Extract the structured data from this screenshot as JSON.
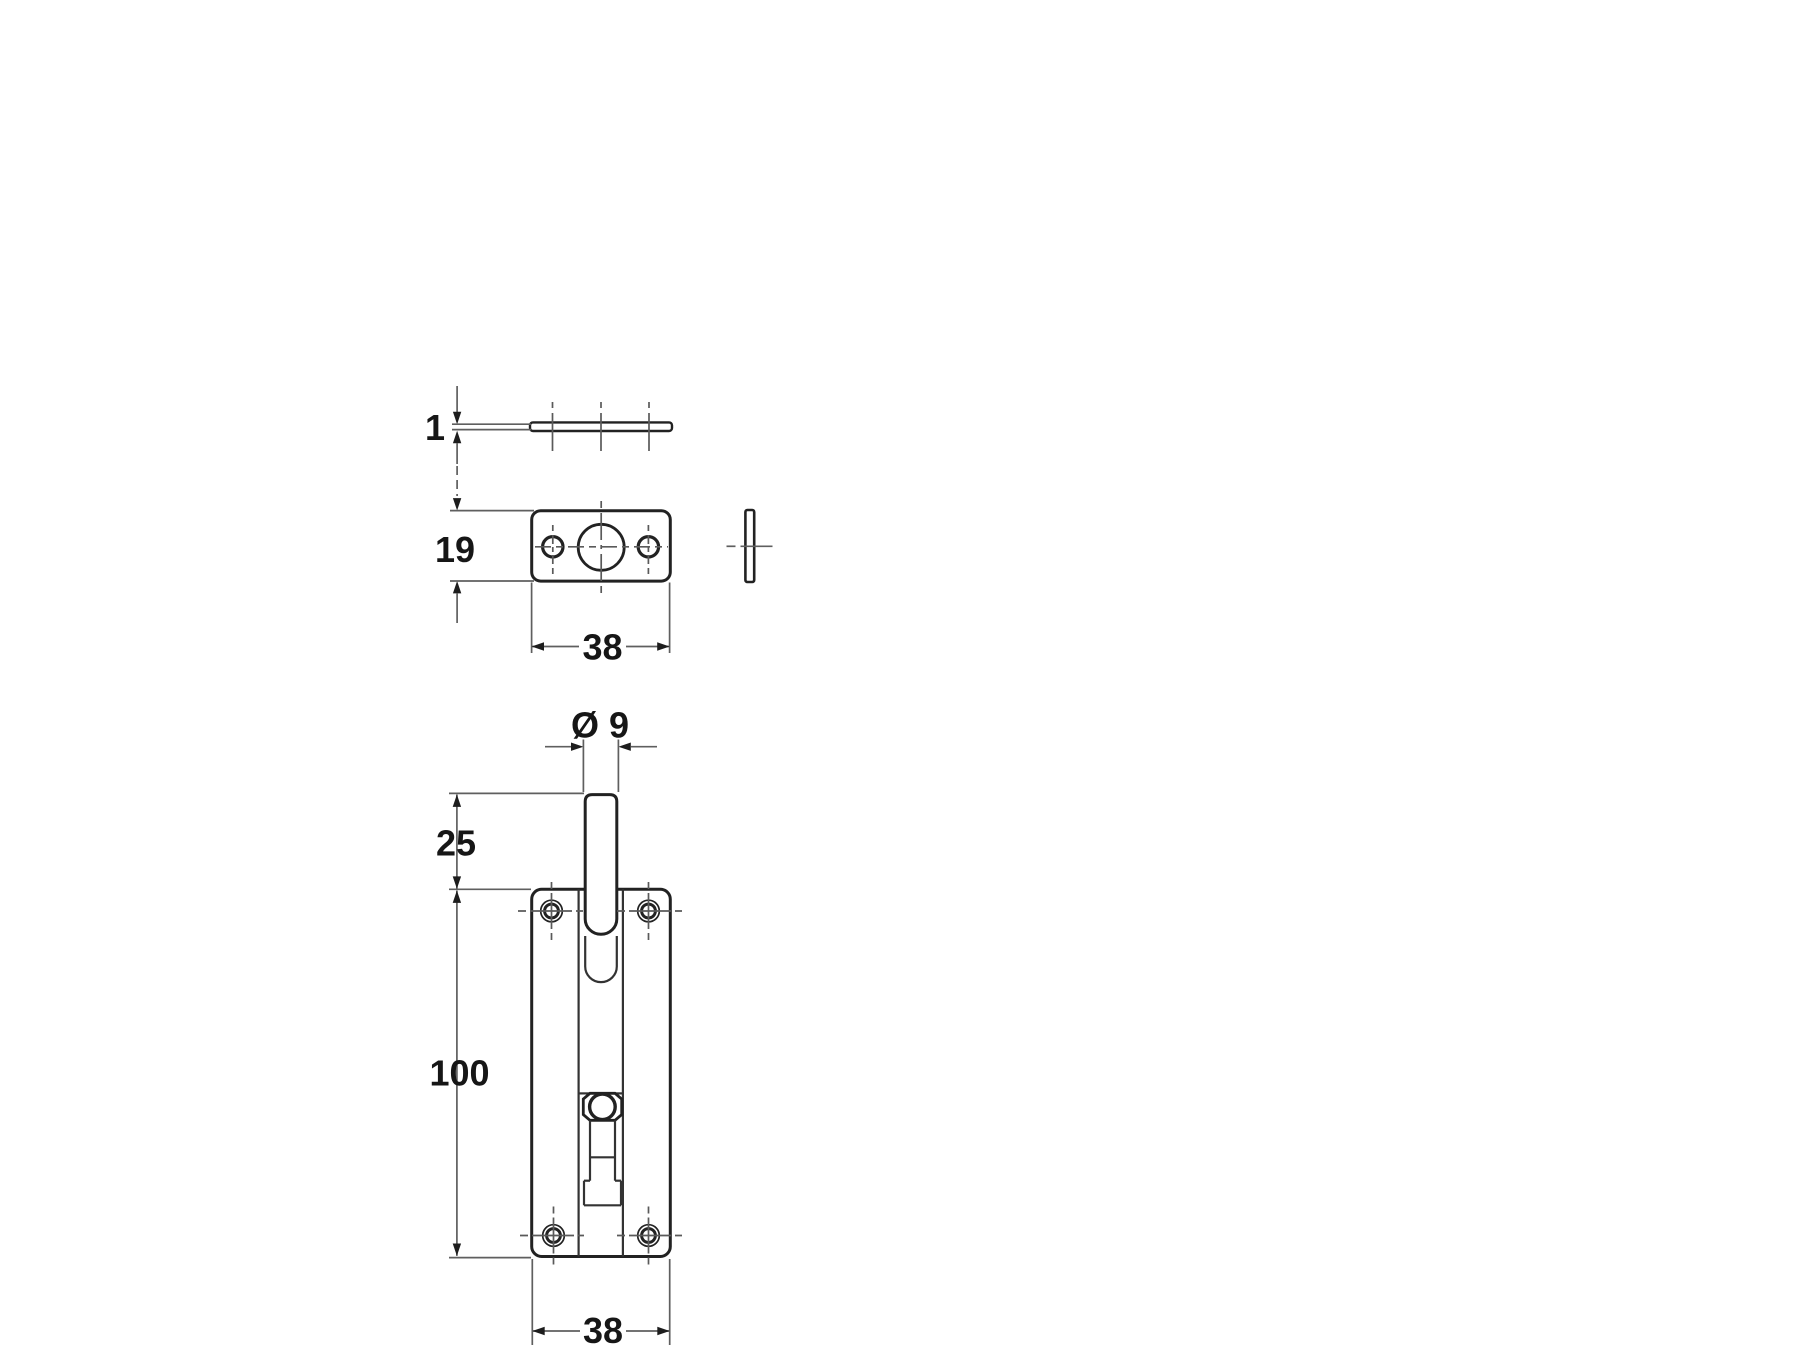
{
  "drawing": {
    "colors": {
      "outline": "#222222",
      "dimension_lines": "#5f5f5f",
      "text": "#161616",
      "background": "#ffffff"
    },
    "dimensions": {
      "plate_thickness": "1",
      "keep_height": "19",
      "keep_width": "38",
      "bolt_diameter": "Ø 9",
      "bolt_extension": "25",
      "plate_height": "100",
      "plate_width": "38"
    }
  }
}
